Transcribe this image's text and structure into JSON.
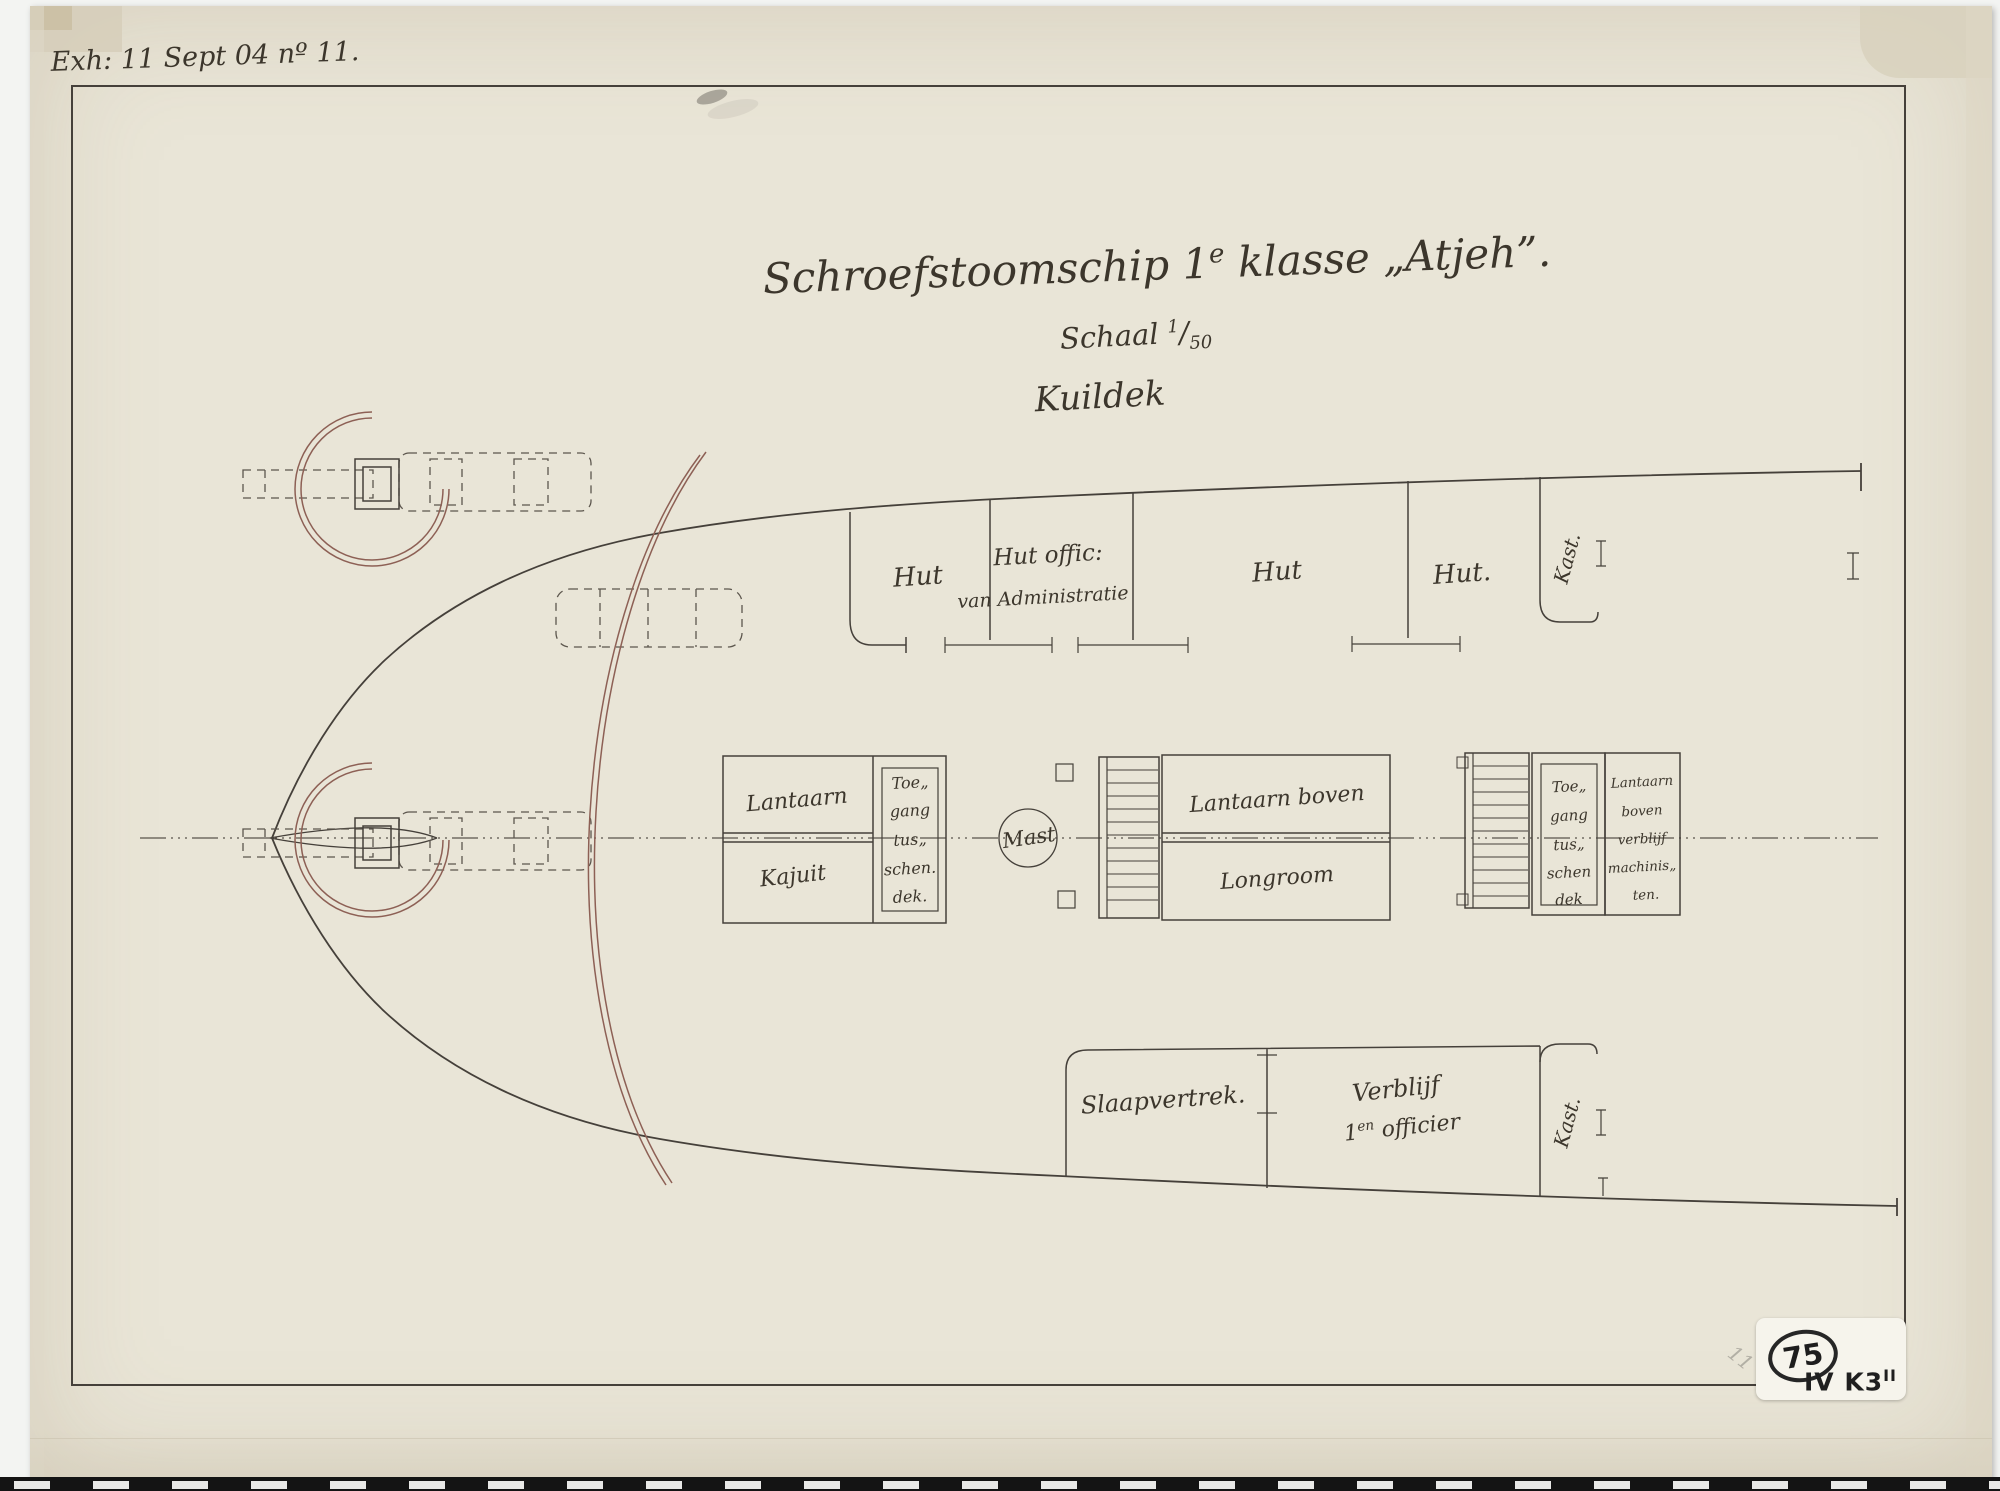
{
  "document": {
    "inscription": "Exh: 11 Sept 04 nº 11.",
    "side_note": "S1004(69)"
  },
  "title_block": {
    "title_p1": "Schroefstoomschip 1",
    "title_sup": "e",
    "title_p2": " klasse „Atjeh”.",
    "scale_label": "Schaal ",
    "scale_num": "1",
    "scale_den": "50",
    "deck_name": "Kuildek"
  },
  "upper_cabins": {
    "cabin1": "Hut",
    "cabin2_line1": "Hut offic:",
    "cabin2_line2": "van Administratie",
    "cabin3": "Hut",
    "cabin4": "Hut.",
    "closet": "Kast."
  },
  "midline": {
    "lantern_cabin_top": "Lantaarn",
    "lantern_cabin_bottom": "Kajuit",
    "access_fore": [
      "Toe„",
      "gang",
      "tus„",
      "schen.",
      "dek."
    ],
    "mast": "Mast",
    "lantern_longroom_top": "Lantaarn boven",
    "lantern_longroom_bottom": "Longroom",
    "access_aft": [
      "Toe„",
      "gang",
      "tus„",
      "schen",
      "dek"
    ],
    "lantern_engineers": [
      "Lantaarn",
      "boven",
      "verblijf",
      "machinis„",
      "ten."
    ]
  },
  "lower_cabins": {
    "sleeping": "Slaapvertrek.",
    "officer_line1": "Verblijf",
    "officer_num": "1",
    "officer_sup": "en",
    "officer_rest": " officier",
    "closet": "Kast."
  },
  "stamp": {
    "number": "75",
    "code": "IV K3",
    "code_sup": "II",
    "pencil": "11"
  }
}
